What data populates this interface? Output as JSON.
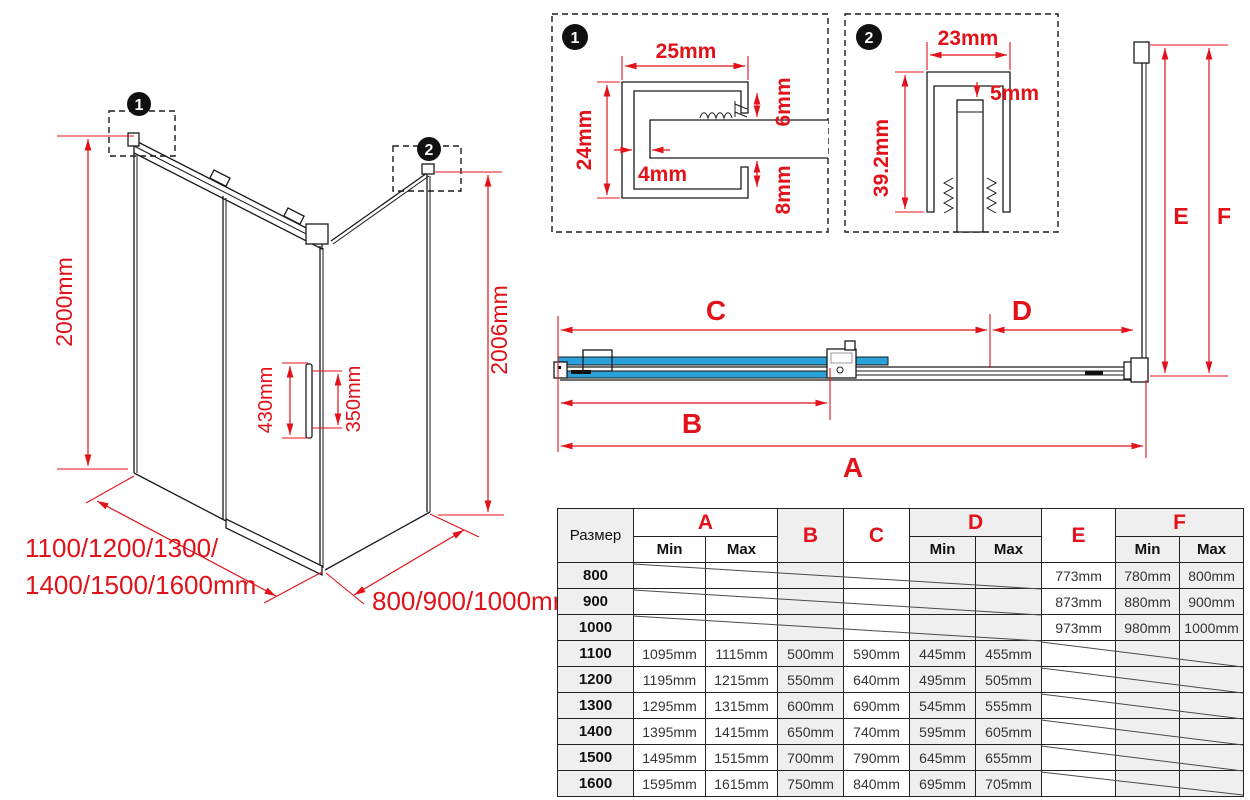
{
  "detail1": {
    "callout": "1",
    "dim_width": "25mm",
    "dim_height": "24mm",
    "dim_gap": "4mm",
    "dim_top_inset": "6mm",
    "dim_bottom_inset": "8mm"
  },
  "detail2": {
    "callout": "2",
    "dim_width": "23mm",
    "dim_glass_gap": "5mm",
    "dim_height": "39.2mm"
  },
  "iso_view": {
    "callout1": "1",
    "callout2": "2",
    "height_front": "2000mm",
    "height_side": "2006mm",
    "handle_length": "430mm",
    "handle_hole_spacing": "350mm",
    "front_width_line1": "1100/1200/1300/",
    "front_width_line2": "1400/1500/1600mm",
    "side_depth": "800/900/1000mm"
  },
  "top_view": {
    "label_a": "A",
    "label_b": "B",
    "label_c": "C",
    "label_d": "D",
    "label_e": "E",
    "label_f": "F"
  },
  "table": {
    "size_header": "Размер",
    "col_a": "A",
    "col_b": "B",
    "col_c": "C",
    "col_d": "D",
    "col_e": "E",
    "col_f": "F",
    "min_label": "Min",
    "max_label": "Max",
    "rows": [
      {
        "size": "800",
        "a_min": "",
        "a_max": "",
        "b": "",
        "c": "",
        "d_min": "",
        "d_max": "",
        "e": "773mm",
        "f_min": "780mm",
        "f_max": "800mm"
      },
      {
        "size": "900",
        "a_min": "",
        "a_max": "",
        "b": "",
        "c": "",
        "d_min": "",
        "d_max": "",
        "e": "873mm",
        "f_min": "880mm",
        "f_max": "900mm"
      },
      {
        "size": "1000",
        "a_min": "",
        "a_max": "",
        "b": "",
        "c": "",
        "d_min": "",
        "d_max": "",
        "e": "973mm",
        "f_min": "980mm",
        "f_max": "1000mm"
      },
      {
        "size": "1100",
        "a_min": "1095mm",
        "a_max": "1115mm",
        "b": "500mm",
        "c": "590mm",
        "d_min": "445mm",
        "d_max": "455mm",
        "e": "",
        "f_min": "",
        "f_max": ""
      },
      {
        "size": "1200",
        "a_min": "1195mm",
        "a_max": "1215mm",
        "b": "550mm",
        "c": "640mm",
        "d_min": "495mm",
        "d_max": "505mm",
        "e": "",
        "f_min": "",
        "f_max": ""
      },
      {
        "size": "1300",
        "a_min": "1295mm",
        "a_max": "1315mm",
        "b": "600mm",
        "c": "690mm",
        "d_min": "545mm",
        "d_max": "555mm",
        "e": "",
        "f_min": "",
        "f_max": ""
      },
      {
        "size": "1400",
        "a_min": "1395mm",
        "a_max": "1415mm",
        "b": "650mm",
        "c": "740mm",
        "d_min": "595mm",
        "d_max": "605mm",
        "e": "",
        "f_min": "",
        "f_max": ""
      },
      {
        "size": "1500",
        "a_min": "1495mm",
        "a_max": "1515mm",
        "b": "700mm",
        "c": "790mm",
        "d_min": "645mm",
        "d_max": "655mm",
        "e": "",
        "f_min": "",
        "f_max": ""
      },
      {
        "size": "1600",
        "a_min": "1595mm",
        "a_max": "1615mm",
        "b": "750mm",
        "c": "840mm",
        "d_min": "695mm",
        "d_max": "705mm",
        "e": "",
        "f_min": "",
        "f_max": ""
      }
    ]
  },
  "colors": {
    "dimension_red": "#e11219",
    "glass_blue": "#2aa1d8",
    "table_shade": "#efefef",
    "line_black": "#1a1a1a"
  }
}
